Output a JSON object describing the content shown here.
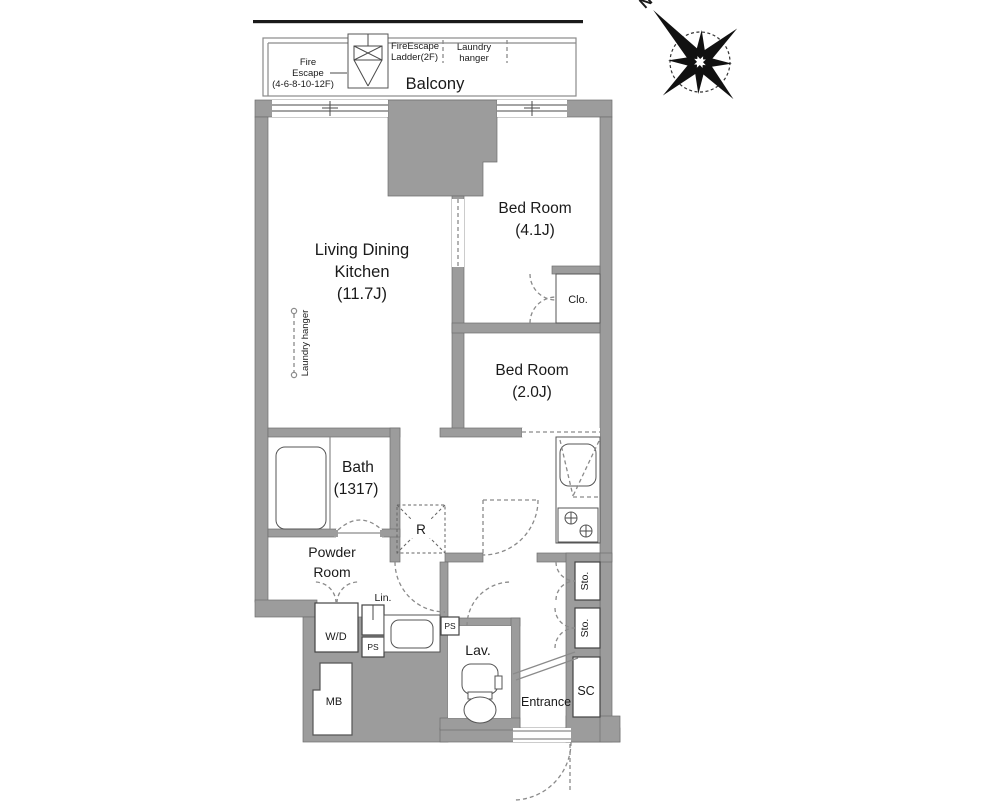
{
  "colors": {
    "wall": "#9c9c9c",
    "wall_edge": "#6e6e6e",
    "line": "#4a4a4a",
    "dash": "#8a8a8a",
    "text": "#1a1a1a"
  },
  "compass": {
    "north": "N"
  },
  "balcony": {
    "label": "Balcony",
    "fire_escape": [
      "Fire",
      "Escape",
      "(4-6-8-10-12F)"
    ],
    "ladder": [
      "FireEscape",
      "Ladder(2F)"
    ],
    "laundry_hanger": [
      "Laundry",
      "hanger"
    ]
  },
  "rooms": {
    "ldk": {
      "line1": "Living Dining",
      "line2": "Kitchen",
      "size": "(11.7J)"
    },
    "ldk_laundry_hanger": "Laundry hanger",
    "bedroom1": {
      "name": "Bed Room",
      "size": "(4.1J)"
    },
    "bedroom2": {
      "name": "Bed Room",
      "size": "(2.0J)"
    },
    "closet": "Clo.",
    "bath": {
      "name": "Bath",
      "size": "(1317)"
    },
    "powder_room": {
      "line1": "Powder",
      "line2": "Room"
    },
    "refrigerator": "R",
    "lavatory": "Lav.",
    "entrance": "Entrance",
    "shoe_closet": "SC",
    "storage_top": "Sto.",
    "storage_bottom": "Sto.",
    "linen": "Lin.",
    "washer_dryer": "W/D",
    "pipe_space_left": "PS",
    "pipe_space_right": "PS",
    "meter_box": "MB"
  }
}
